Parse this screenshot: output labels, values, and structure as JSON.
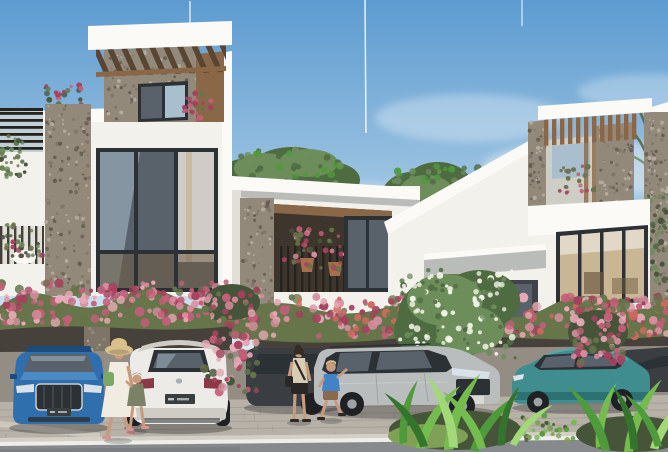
{
  "image": {
    "width": 668,
    "height": 452,
    "kind": "architectural-exterior-rendering"
  },
  "palette": {
    "skyTop": "#5d9bd0",
    "skyMid": "#a3c7e3",
    "skyHorizon": "#dcebf4",
    "cloudWhite": "#ffffff",
    "facadeWhite": "#f3f1ec",
    "facadeBright": "#fbfaf6",
    "facadeShade": "#e1dfd8",
    "facadeDim": "#cfcec6",
    "soffitGrey": "#b9bcb9",
    "stoneBase": "#93897b",
    "stoneDark": "#635c50",
    "stoneLight": "#b7aea0",
    "stoneMid": "#7e7568",
    "woodMid": "#8a6847",
    "woodDark": "#584533",
    "woodLight": "#a8845c",
    "frameDark": "#2c3136",
    "glassBlue": "#a9bfcd",
    "glassDark": "#59626a",
    "interiorWarm": "#c9b694",
    "interiorDark": "#6e5b44",
    "curtain": "#ece7de",
    "railDark": "#26231f",
    "hedgeGreen": "#66754a",
    "hedgeGreenDark": "#46543a",
    "bgnvPink": "#d88da0",
    "bgnvRose": "#c25f78",
    "bgnvDeep": "#a4415c",
    "bgnvLightPink": "#e7aab6",
    "bgnvCoral": "#cf6a5e",
    "treeGreen": "#6d8d5b",
    "treeGreenDark": "#4e6b42",
    "blossomWhite": "#f2f4e8",
    "leafBright": "#74bc4e",
    "leafMid": "#4f9a3b",
    "leafDark": "#35742c",
    "leafLight": "#a2d878",
    "grassGreen": "#7fa055",
    "pavementLight": "#b7b1a7",
    "pavementShade": "#938d83",
    "carportShadow": "#46423b",
    "paverLine": "#7e786e",
    "curbWhite": "#efede8",
    "curbTop": "#d3cec6",
    "roadGrey": "#868a8d",
    "roadDark": "#74787b",
    "audiBlue": "#2f6fae",
    "audiBlueDark": "#1d4c7c",
    "audiBlueLight": "#4b8ac2",
    "carWhite": "#edebe7",
    "carWhiteShade": "#cfccc6",
    "kiaSilver": "#b9bdbe",
    "kiaSilverDark": "#8e9395",
    "tealCar": "#3f8d8e",
    "tealDark": "#2b6a6d",
    "tealLight": "#5aa8a6",
    "darkCar": "#3a3e42",
    "darkCar2": "#2c3033",
    "tyreDark": "#1f2124",
    "hubGrey": "#9ea3a6",
    "plateDark": "#3a3d3f",
    "plateLight": "#d8d8d4",
    "tailRed": "#8a3a45",
    "lightLens": "#d9e2e8",
    "skin": "#c89b7d",
    "hatStraw": "#d9bf8a",
    "dressWhite": "#f1ece2",
    "bagGreen": "#79a964",
    "oliveDress": "#7b8164",
    "hairBrown": "#8a6f4d",
    "hairDark": "#352c25",
    "hairBlond": "#d6bd8c",
    "beigeTop": "#d8cdb2",
    "blackCloth": "#2a2826",
    "blueShirt": "#4482c6",
    "brownShorts": "#8a6a4b",
    "sandalPink": "#d69490",
    "potTerracotta": "#a86f4b",
    "shadow": "#15151a"
  },
  "scene": {
    "sky": {
      "elements": [
        "soft-clouds",
        "vertical-contrails"
      ]
    },
    "buildings": [
      {
        "name": "townhouse-left",
        "features": [
          "rooftop-pergola-tower",
          "stone-pier",
          "large-picture-window",
          "roof-terrace-railing",
          "balcony-planters",
          "carport"
        ]
      },
      {
        "name": "townhouse-middle",
        "features": [
          "flat-roof-fascia",
          "stone-column",
          "recessed-balcony",
          "hanging-flower-planters",
          "carport"
        ]
      },
      {
        "name": "townhouse-right",
        "features": [
          "sloped-roof-fascia",
          "rooftop-pergola-tower",
          "stone-accent-wall",
          "picture-window",
          "entry-canopy"
        ]
      }
    ],
    "vegetation": [
      "bougainvillea-hedge",
      "bougainvillea-cascade",
      "white-flowering-tree",
      "tropical-foreground-plants",
      "background-trees",
      "palm-fronds"
    ],
    "vehicles": [
      {
        "name": "car-audi-blue",
        "view": "front",
        "color_key": "audiBlue"
      },
      {
        "name": "car-mazda-white",
        "view": "rear",
        "color_key": "carWhite"
      },
      {
        "name": "car-suv-dark",
        "view": "side",
        "color_key": "darkCar"
      },
      {
        "name": "car-kia-silver",
        "view": "front-three-quarter",
        "color_key": "kiaSilver"
      },
      {
        "name": "car-sedan-teal",
        "view": "side",
        "color_key": "tealCar"
      },
      {
        "name": "car-dark-right",
        "view": "partial",
        "color_key": "darkCar"
      }
    ],
    "people": [
      {
        "name": "woman-sunhat",
        "details": [
          "straw-hat",
          "white-dress",
          "green-bag"
        ]
      },
      {
        "name": "girl-olive",
        "details": [
          "olive-dress"
        ]
      },
      {
        "name": "woman-beige",
        "details": [
          "beige-top",
          "black-shorts",
          "crossbody-bag"
        ]
      },
      {
        "name": "boy-blue",
        "details": [
          "blue-shirt",
          "brown-shorts"
        ]
      }
    ],
    "ground": [
      "paved-sidewalk",
      "white-curb-line",
      "asphalt-road"
    ]
  }
}
